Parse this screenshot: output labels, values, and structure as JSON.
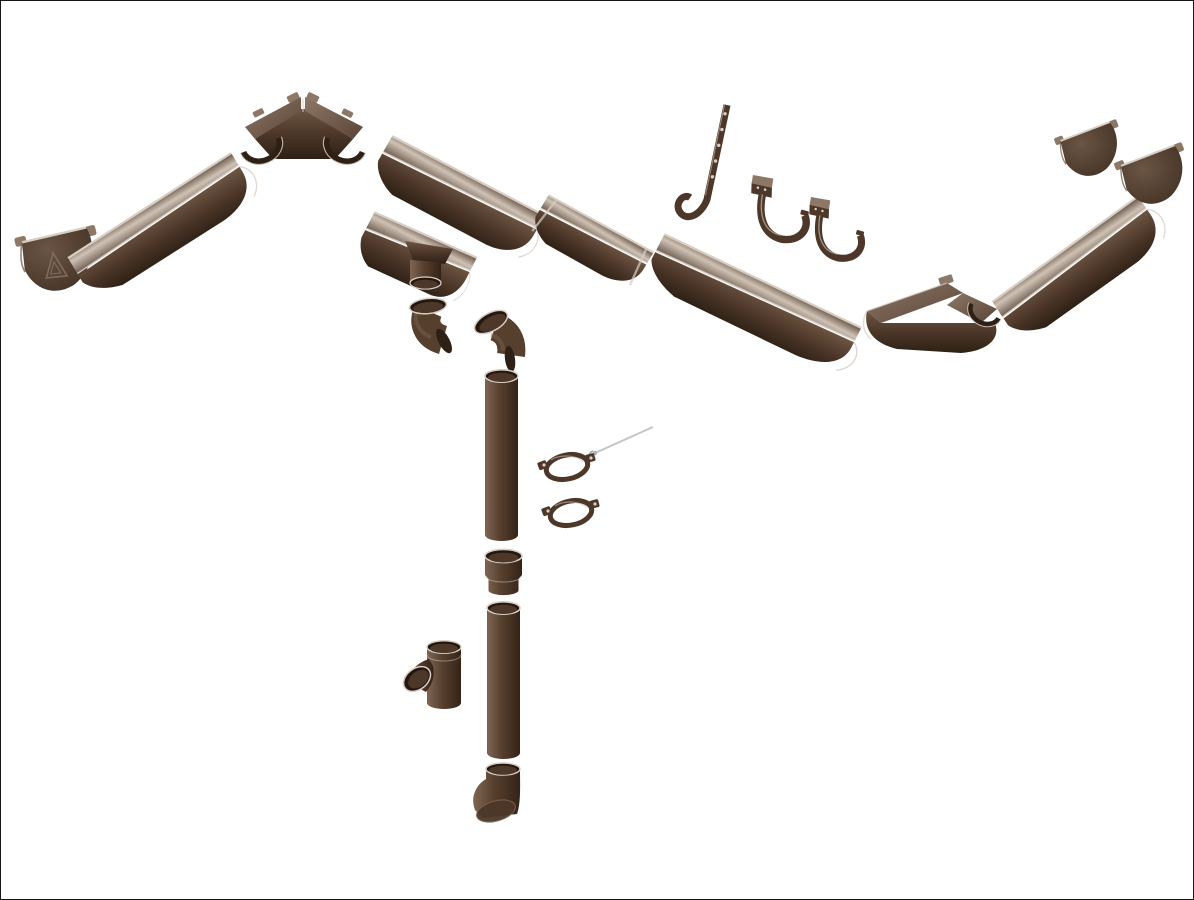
{
  "scene": {
    "kind": "exploded product diagram",
    "subject": "brown half-round rain gutter and downpipe system components on white background"
  },
  "colors": {
    "background": "#ffffff",
    "frame": "#161616",
    "body_light": "#6e5543",
    "body": "#4c3729",
    "body_deep": "#2e2015",
    "interior_light": "#cfc2b5",
    "interior": "#9c8a7b",
    "interior_dark": "#6e5d4f",
    "pipe_light": "#7a6150",
    "pipe": "#573f2e",
    "pipe_deep": "#332317",
    "face_light": "#8d7767",
    "face": "#5a4536",
    "cap_light": "#6b5544",
    "cap_dark": "#3a2a1e",
    "rim": "#d8cec4",
    "mouth": "#241810",
    "hole": "#d8d0c8",
    "metal": "#c3c7ca"
  },
  "components": [
    {
      "id": "endcap-left",
      "name": "gutter end cap with embossed brand triangle"
    },
    {
      "id": "gutter-left",
      "name": "gutter section"
    },
    {
      "id": "corner-inner",
      "name": "gutter 90-degree inside corner"
    },
    {
      "id": "gutter-center",
      "name": "gutter section"
    },
    {
      "id": "gutter-outlet",
      "name": "gutter outlet funnel with downpipe spigot"
    },
    {
      "id": "gutter-union",
      "name": "gutter union connector"
    },
    {
      "id": "hook-long",
      "name": "long strap gutter hook with screw holes"
    },
    {
      "id": "hook-short-1",
      "name": "fascia gutter hook"
    },
    {
      "id": "hook-short-2",
      "name": "fascia gutter hook"
    },
    {
      "id": "gutter-right",
      "name": "gutter section"
    },
    {
      "id": "corner-outer",
      "name": "gutter 90-degree outside corner"
    },
    {
      "id": "gutter-far-right",
      "name": "gutter section"
    },
    {
      "id": "endcap-right-1",
      "name": "gutter end cap"
    },
    {
      "id": "endcap-right-2",
      "name": "gutter end cap"
    },
    {
      "id": "elbow-1",
      "name": "downpipe elbow bend"
    },
    {
      "id": "elbow-2",
      "name": "downpipe elbow bend"
    },
    {
      "id": "downpipe-upper",
      "name": "downpipe tube"
    },
    {
      "id": "mounting-screw",
      "name": "clamp mounting screw"
    },
    {
      "id": "pipe-clamp-1",
      "name": "downpipe clamp ring"
    },
    {
      "id": "pipe-clamp-2",
      "name": "downpipe clamp ring"
    },
    {
      "id": "pipe-coupler",
      "name": "downpipe socket coupler"
    },
    {
      "id": "downpipe-lower",
      "name": "downpipe tube"
    },
    {
      "id": "tee",
      "name": "downpipe tee branch"
    },
    {
      "id": "shoe",
      "name": "downpipe shoe outflow elbow"
    }
  ]
}
